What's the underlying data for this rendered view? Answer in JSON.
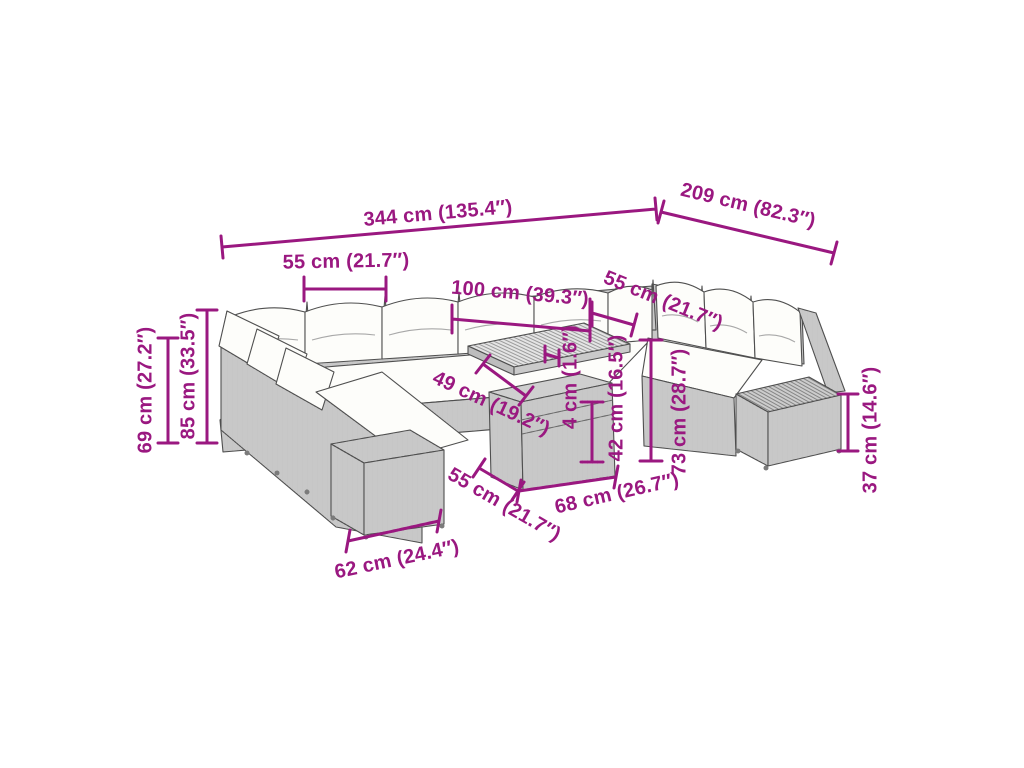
{
  "colors": {
    "accent": "#9A1880",
    "outline": "#4f4f4f",
    "wicker": "#dcdcdc",
    "cushion": "#fdfdfa",
    "background": "#ffffff"
  },
  "dims": {
    "d344": "344 cm (135.4″)",
    "d209": "209 cm (82.3″)",
    "d55_top": "55 cm (21.7″)",
    "d100": "100 cm (39.3″)",
    "d55_right": "55 cm (21.7″)",
    "d69": "69 cm (27.2″)",
    "d85": "85 cm (33.5″)",
    "d49": "49 cm (19.2″)",
    "d4": "4 cm (1.6″)",
    "d42": "42 cm (16.5″)",
    "d73": "73 cm (28.7″)",
    "d37": "37 cm (14.6″)",
    "d55_bottom": "55 cm (21.7″)",
    "d68": "68 cm (26.7″)",
    "d62": "62 cm (24.4″)"
  }
}
